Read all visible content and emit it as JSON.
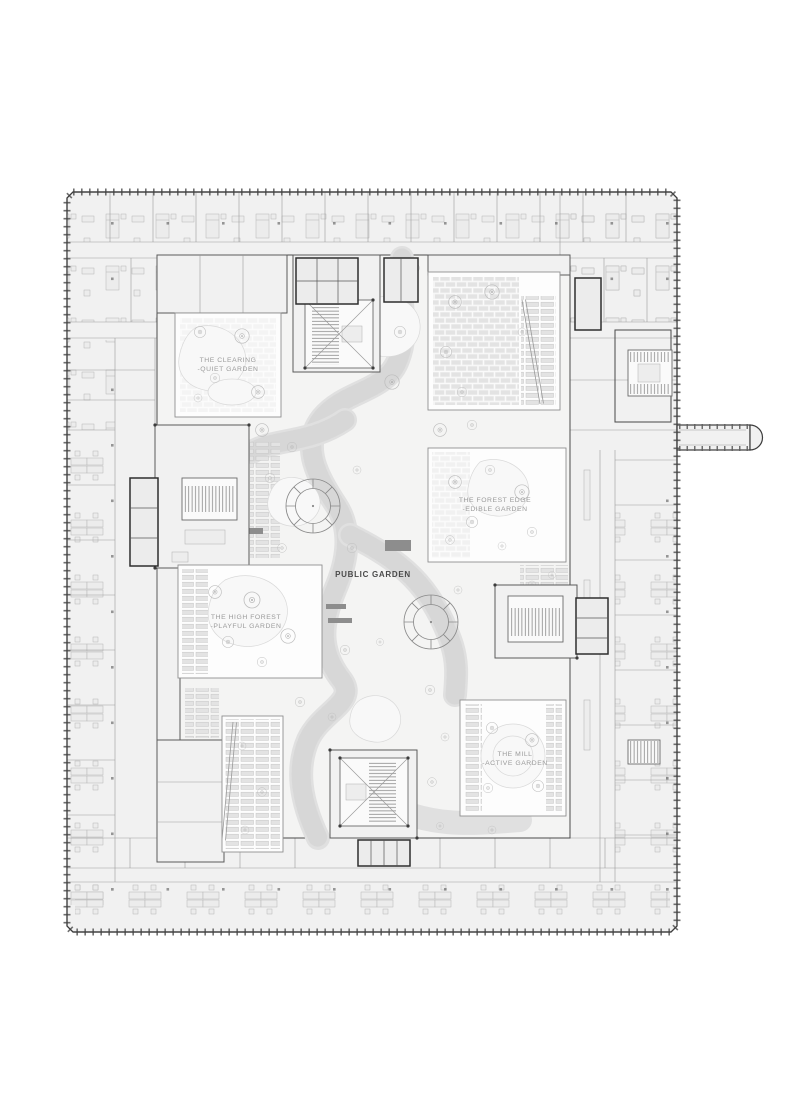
{
  "plan": {
    "labels": {
      "clearing": {
        "line1": "THE CLEARING",
        "line2": "-QUIET GARDEN"
      },
      "forest_edge": {
        "line1": "THE FOREST EDGE",
        "line2": "-EDIBLE GARDEN"
      },
      "public_garden": "PUBLIC GARDEN",
      "high_forest": {
        "line1": "THE HIGH FOREST",
        "line2": "-PLAYFUL GARDEN"
      },
      "mill": {
        "line1": "THE MILL",
        "line2": "-ACTIVE GARDEN"
      }
    },
    "colors": {
      "paper": "#ffffff",
      "floor": "#f1f1f1",
      "wall_dark": "#3c3c3c",
      "partition_gray": "#9b9b9b",
      "furniture_gray": "#b5b5b5",
      "paving_gray": "#dedede",
      "bench_dark": "#8d8d8d",
      "label_gray": "#9a9a9a",
      "label_dark": "#4a4a4a"
    }
  }
}
